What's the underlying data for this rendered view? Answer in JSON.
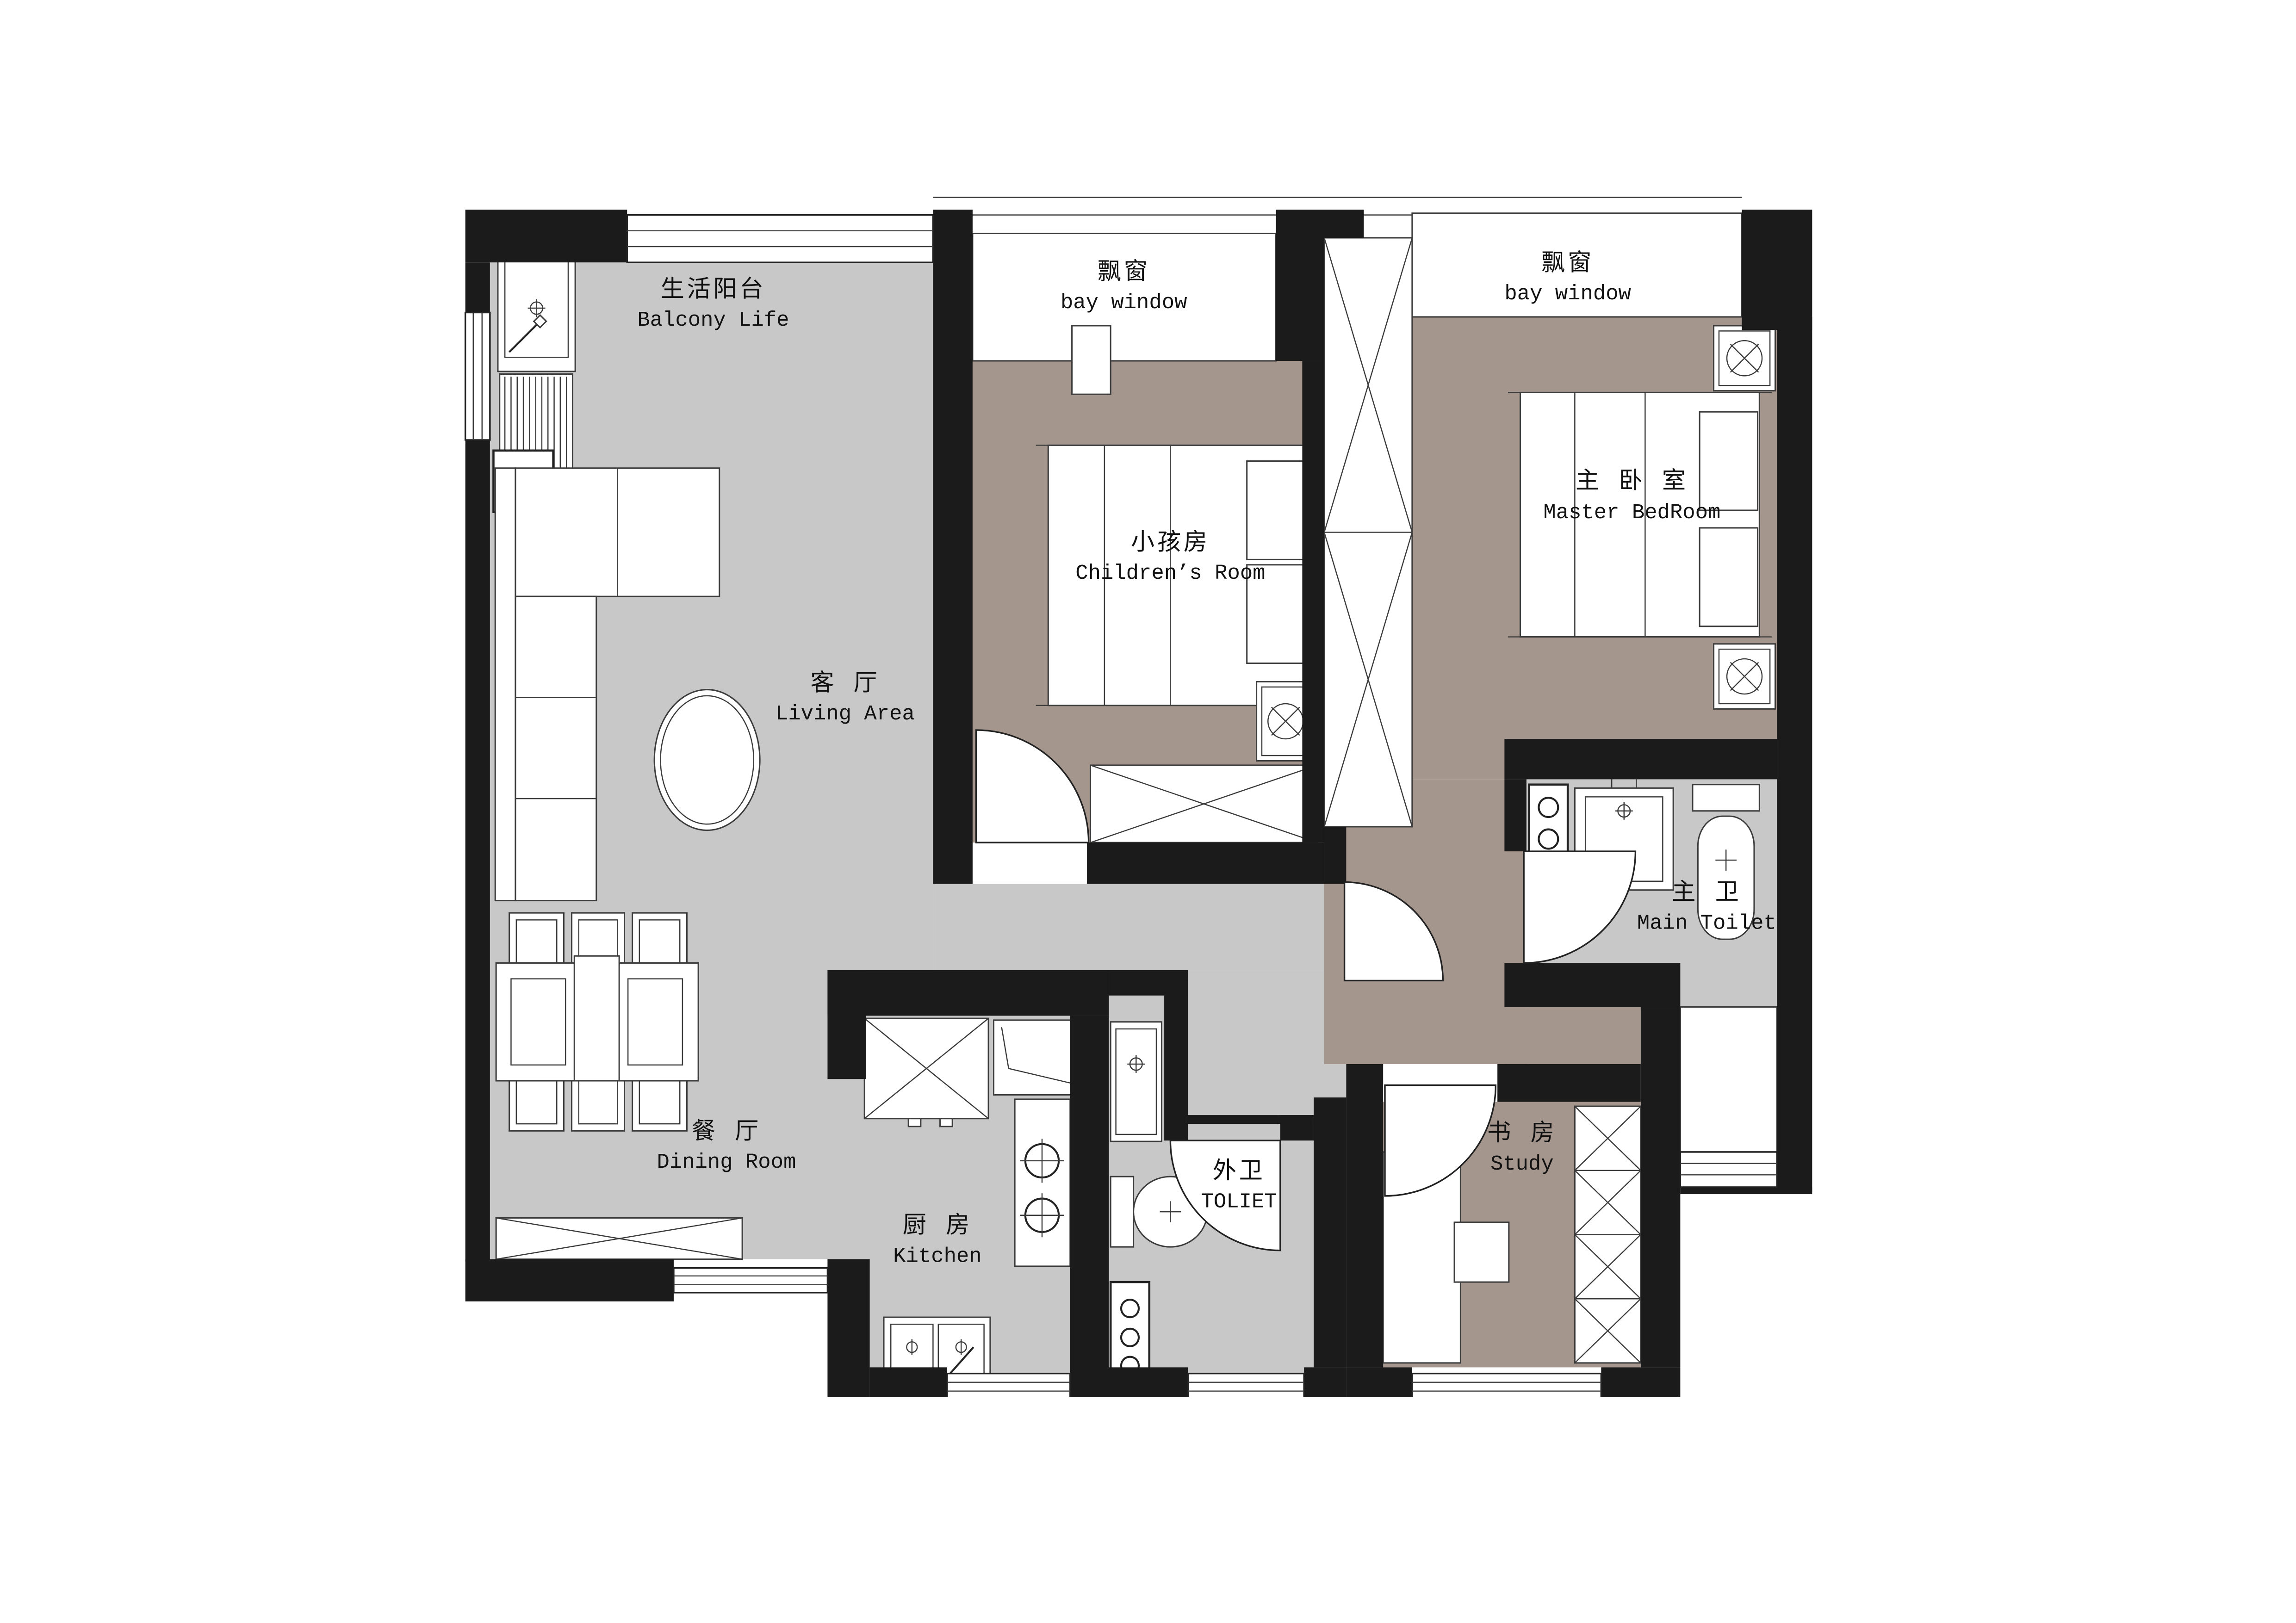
{
  "plan": {
    "rooms": [
      {
        "id": "balcony",
        "zh": "生活阳台",
        "en": "Balcony Life"
      },
      {
        "id": "bay-window-1",
        "zh": "飘窗",
        "en": "bay window"
      },
      {
        "id": "bay-window-2",
        "zh": "飘窗",
        "en": "bay window"
      },
      {
        "id": "childrens-room",
        "zh": "小孩房",
        "en": "Children’s Room"
      },
      {
        "id": "master-bedroom",
        "zh": "主 卧 室",
        "en": "Master BedRoom"
      },
      {
        "id": "living-area",
        "zh": "客 厅",
        "en": "Living Area"
      },
      {
        "id": "main-toilet",
        "zh": "主 卫",
        "en": "Main Toilet"
      },
      {
        "id": "dining-room",
        "zh": "餐 厅",
        "en": "Dining Room"
      },
      {
        "id": "kitchen",
        "zh": "厨 房",
        "en": "Kitchen"
      },
      {
        "id": "second-toilet",
        "zh": "外卫",
        "en": "TOLIET"
      },
      {
        "id": "study",
        "zh": "书 房",
        "en": "Study"
      }
    ],
    "colors": {
      "wall": "#1b1b1b",
      "floor_light_gray": "#c8c8c8",
      "floor_warm_taupe": "#a5968d",
      "line": "#3c3c3c",
      "background": "#ffffff"
    },
    "icons": [
      "washing-machine-icon",
      "drying-rack-icon",
      "laundry-sink-icon",
      "sofa",
      "coffee-table",
      "dining-table",
      "dining-chair",
      "sideboard-cabinet",
      "fridge",
      "corner-counter",
      "stove-icon",
      "kitchen-sink-icon",
      "vanity-sink-icon",
      "toilet-icon",
      "bed",
      "pillow",
      "nightstand",
      "lamp-icon",
      "wardrobe",
      "duct-shaft",
      "desk",
      "desk-chair",
      "door-swing",
      "window"
    ]
  }
}
